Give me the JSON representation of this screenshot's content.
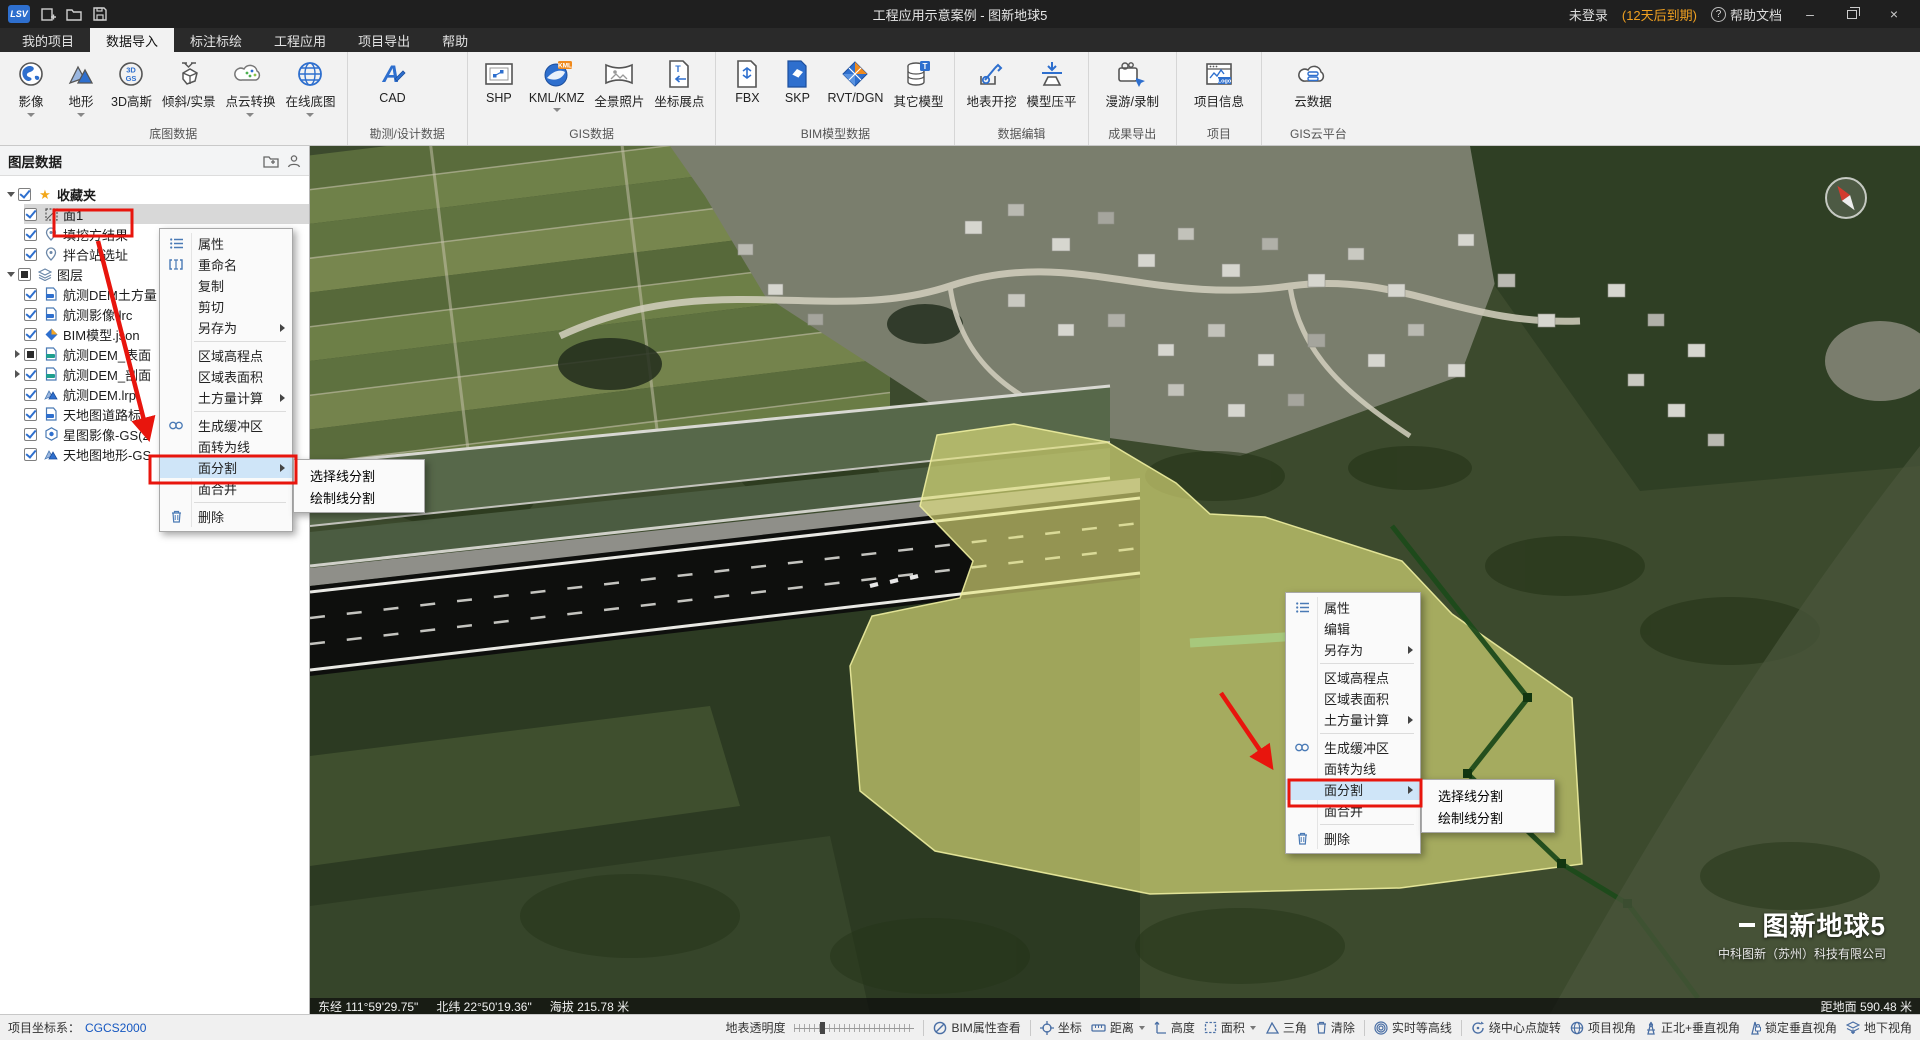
{
  "colors": {
    "accent_blue": "#2e6fce",
    "annotation_red": "#e8150d",
    "menu_highlight": "#cfe5f8",
    "license_orange": "#f0a020",
    "crs_blue": "#1557c0"
  },
  "title_bar": {
    "title": "工程应用示意案例 - 图新地球5",
    "login": "未登录",
    "license": "(12天后到期)",
    "help": "帮助文档"
  },
  "tabs": {
    "items": [
      "我的项目",
      "数据导入",
      "标注标绘",
      "工程应用",
      "项目导出",
      "帮助"
    ],
    "active": "数据导入"
  },
  "ribbon": {
    "groups": [
      {
        "label": "底图数据",
        "items": [
          "影像",
          "地形",
          "3D高斯",
          "倾斜/实景",
          "点云转换",
          "在线底图"
        ]
      },
      {
        "label": "勘测/设计数据",
        "items": [
          "CAD"
        ]
      },
      {
        "label": "GIS数据",
        "items": [
          "SHP",
          "KML/KMZ",
          "全景照片",
          "坐标展点"
        ]
      },
      {
        "label": "BIM模型数据",
        "items": [
          "FBX",
          "SKP",
          "RVT/DGN",
          "其它模型"
        ]
      },
      {
        "label": "数据编辑",
        "items": [
          "地表开挖",
          "模型压平"
        ]
      },
      {
        "label": "成果导出",
        "items": [
          "漫游/录制"
        ]
      },
      {
        "label": "项目",
        "items": [
          "项目信息"
        ]
      },
      {
        "label": "GIS云平台",
        "items": [
          "云数据"
        ]
      }
    ]
  },
  "layer_panel": {
    "header": "图层数据",
    "tree": [
      {
        "label": "收藏夹",
        "icon": "star-icon",
        "check": "checked"
      },
      {
        "label": "面1",
        "icon": "polygon-icon",
        "check": "checked",
        "selected": true
      },
      {
        "label": "填挖方结果",
        "icon": "location-pin-icon",
        "check": "checked"
      },
      {
        "label": "拌合站选址",
        "icon": "location-pin-icon",
        "check": "checked"
      },
      {
        "label": "图层",
        "icon": "layers-icon",
        "check": "partial"
      },
      {
        "label": "航测DEM土方量",
        "icon": "doc-icon",
        "check": "checked"
      },
      {
        "label": "航测影像.lrc",
        "icon": "doc-icon",
        "check": "checked"
      },
      {
        "label": "BIM模型.json",
        "icon": "model-diamond-icon",
        "check": "checked"
      },
      {
        "label": "航测DEM_表面",
        "icon": "doc-icon",
        "check": "partial"
      },
      {
        "label": "航测DEM_剖面",
        "icon": "doc-icon",
        "check": "checked"
      },
      {
        "label": "航测DEM.lrp",
        "icon": "terrain-icon",
        "check": "checked"
      },
      {
        "label": "天地图道路标",
        "icon": "doc-icon",
        "check": "checked"
      },
      {
        "label": "星图影像-GS(2",
        "icon": "globe-hex-icon",
        "check": "checked"
      },
      {
        "label": "天地图地形-GS",
        "icon": "terrain-icon",
        "check": "checked"
      }
    ]
  },
  "context_menu_left": {
    "items": [
      "属性",
      "重命名",
      "复制",
      "剪切",
      "另存为",
      "区域高程点",
      "区域表面积",
      "土方量计算",
      "生成缓冲区",
      "面转为线",
      "面分割",
      "面合并",
      "删除"
    ]
  },
  "context_menu_right": {
    "items": [
      "属性",
      "编辑",
      "另存为",
      "区域高程点",
      "区域表面积",
      "土方量计算",
      "生成缓冲区",
      "面转为线",
      "面分割",
      "面合并",
      "删除"
    ]
  },
  "split_submenu": {
    "items": [
      "选择线分割",
      "绘制线分割"
    ]
  },
  "map": {
    "coords_bar": {
      "east": "东经 111°59'29.75\"",
      "north": "北纬 22°50'19.36\"",
      "altitude": "海拔 215.78 米",
      "distance_to_ground": "距地面 590.48 米"
    },
    "watermark": {
      "title": "图新地球5",
      "company": "中科图新（苏州）科技有限公司"
    }
  },
  "status_bar": {
    "crs_label": "项目坐标系：",
    "crs_value": "CGCS2000",
    "transparency_label": "地表透明度",
    "buttons": [
      "BIM属性查看",
      "坐标",
      "距离",
      "高度",
      "面积",
      "三角",
      "清除",
      "实时等高线",
      "绕中心点旋转",
      "项目视角",
      "正北+垂直视角",
      "锁定垂直视角",
      "地下视角"
    ]
  }
}
